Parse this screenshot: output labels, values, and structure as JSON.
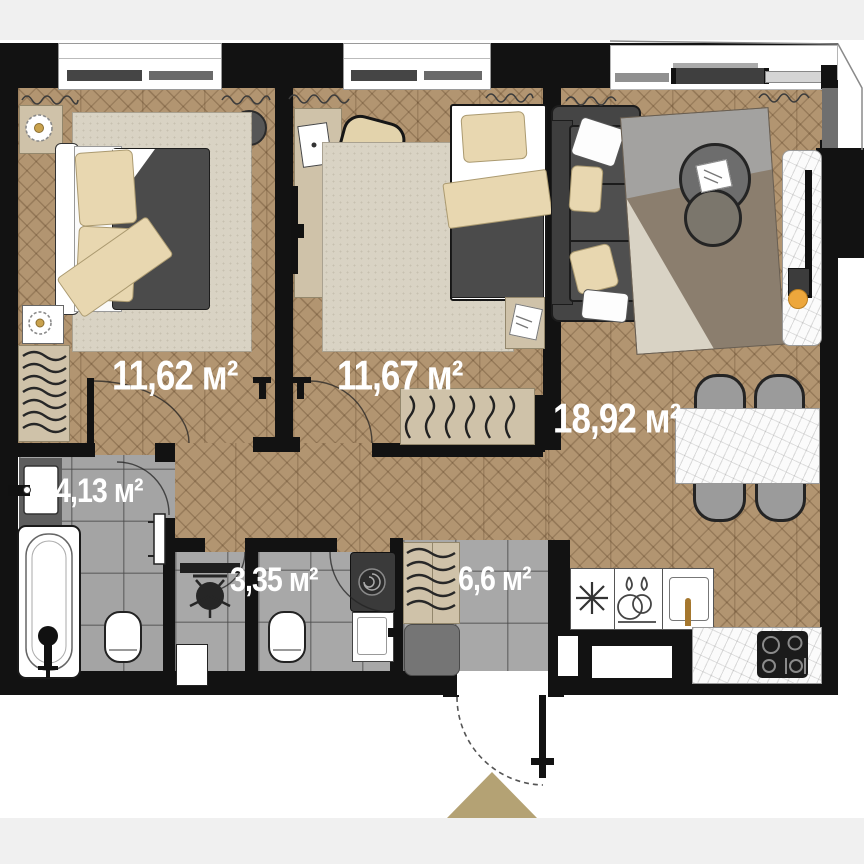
{
  "plan_title": "Apartment floor plan",
  "units": "м²",
  "rooms": [
    {
      "id": "bedroom-1",
      "label": "11,62 м²"
    },
    {
      "id": "bedroom-2",
      "label": "11,67 м²"
    },
    {
      "id": "living-kitchen",
      "label": "18,92 м²"
    },
    {
      "id": "bathroom",
      "label": "4,13 м²"
    },
    {
      "id": "wc-laundry",
      "label": "3,35 м²"
    },
    {
      "id": "hallway",
      "label": "6,6 м²"
    }
  ],
  "colors": {
    "wall": "#121212",
    "wood_floor": "#b29571",
    "tile_floor": "#a8a8a8",
    "rug": "#d9d3c4",
    "furniture_beige": "#cfc2a9",
    "upholstery_dark": "#4b4b4b",
    "marble": "#fbfbfb",
    "accent_orange": "#eda73c",
    "entry_arrow": "#b4a274"
  }
}
